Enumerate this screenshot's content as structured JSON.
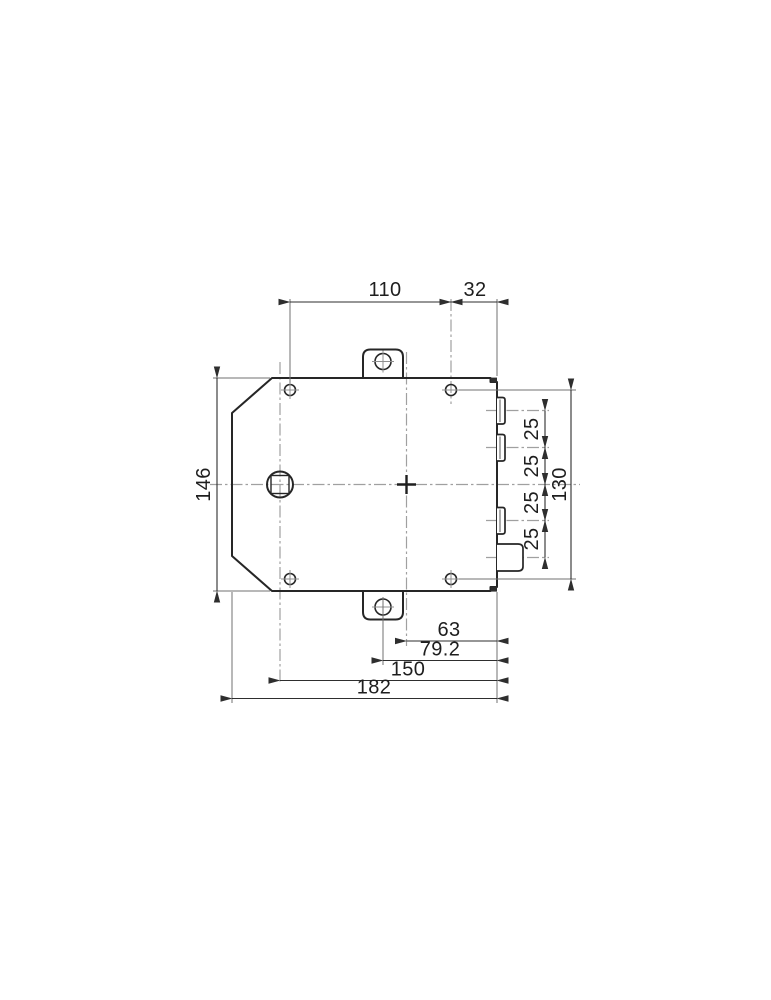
{
  "dimensions": {
    "hole_spacing_horizontal": "110",
    "right_edge_offset": "32",
    "body_height": "146",
    "hole_spacing_vertical": "130",
    "terminal_pitch": [
      "25",
      "25",
      "25",
      "25"
    ],
    "center_to_right_edge": "63",
    "ear_hole_to_right_edge": "79.2",
    "shaft_to_right_edge": "150",
    "body_width": "182"
  },
  "colors": {
    "outline": "#262626",
    "dimension": "#2e2e2e",
    "centerline": "#a0a0a0",
    "background": "#ffffff"
  }
}
